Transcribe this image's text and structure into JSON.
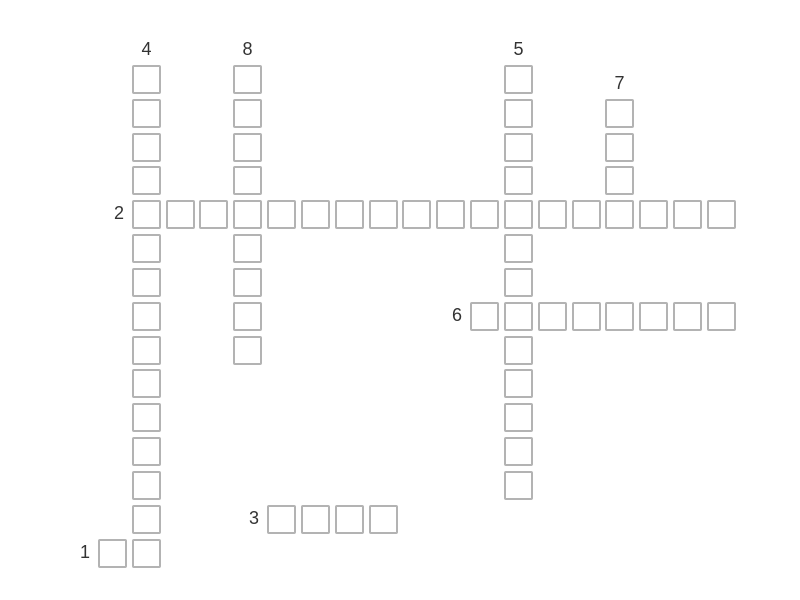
{
  "app": {
    "name": "crossword-puzzle",
    "background_color": "#ffffff"
  },
  "grid": {
    "cell_border_color": "#b3b3b3",
    "cell_fill_color": "#ffffff",
    "label_color": "#333333",
    "rows": 15,
    "cols": 19,
    "cells_are_empty": true
  },
  "words": [
    {
      "number": "1",
      "direction": "across",
      "row": 14,
      "col": 0,
      "length": 2
    },
    {
      "number": "2",
      "direction": "across",
      "row": 4,
      "col": 1,
      "length": 18
    },
    {
      "number": "3",
      "direction": "across",
      "row": 13,
      "col": 5,
      "length": 4
    },
    {
      "number": "4",
      "direction": "down",
      "row": 0,
      "col": 1,
      "length": 15
    },
    {
      "number": "5",
      "direction": "down",
      "row": 0,
      "col": 12,
      "length": 13
    },
    {
      "number": "6",
      "direction": "across",
      "row": 7,
      "col": 11,
      "length": 8
    },
    {
      "number": "7",
      "direction": "down",
      "row": 1,
      "col": 15,
      "length": 4
    },
    {
      "number": "8",
      "direction": "down",
      "row": 0,
      "col": 4,
      "length": 9
    }
  ]
}
